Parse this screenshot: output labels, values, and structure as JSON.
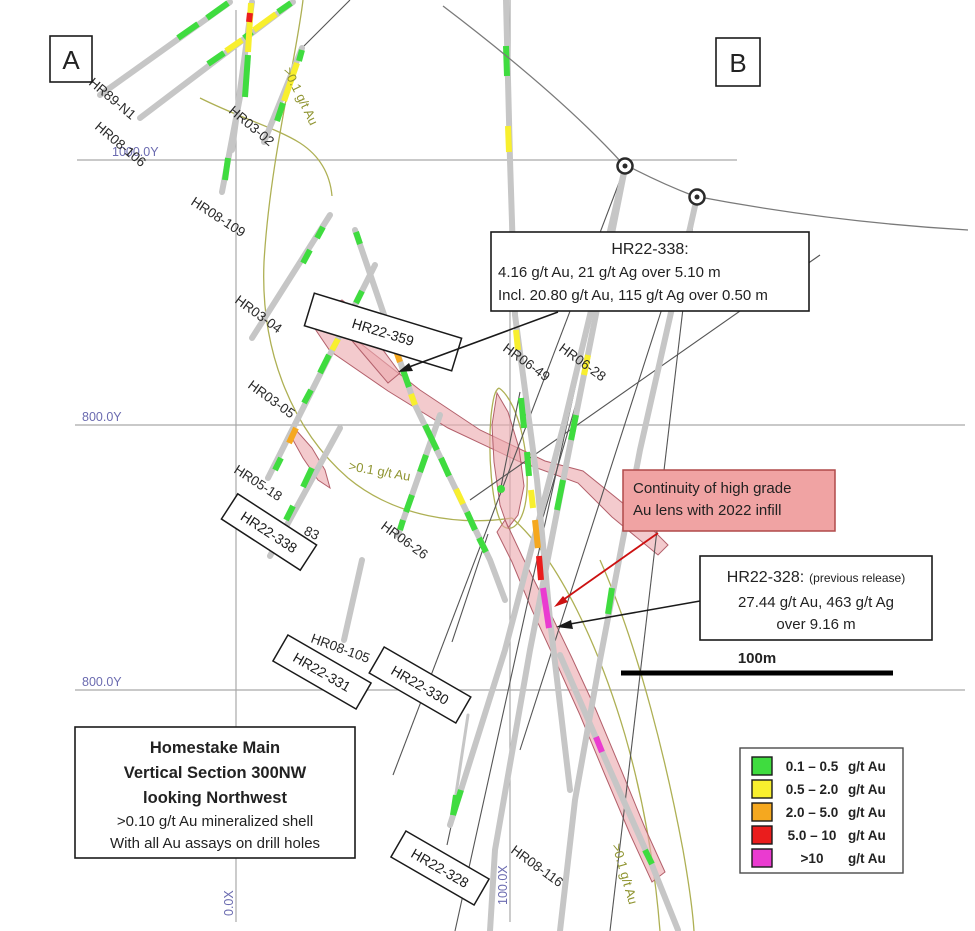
{
  "markers": {
    "a": "A",
    "b": "B"
  },
  "axis_labels": {
    "y1000": "1000.0Y",
    "y800a": "800.0Y",
    "y800b": "800.0Y",
    "x0": "0.0X",
    "x100": "100.0X"
  },
  "drill_labels": [
    "HR89-N1",
    "HR08-106",
    "HR03-02",
    "HR08-109",
    "HR03-04",
    "HR03-05",
    "HR05-18",
    "83",
    "HR06-49",
    "HR06-28",
    "HR06-26",
    "HR08-105",
    "HR08-116"
  ],
  "boxed_labels": [
    "HR22-359",
    "HR22-338",
    "HR22-331",
    "HR22-330",
    "HR22-328"
  ],
  "shell_labels": [
    ">0.1 g/t Au",
    ">0.1 g/t Au",
    ">0.1 g/t Au"
  ],
  "annotations": {
    "hr22_338": {
      "title": "HR22-338:",
      "line1": "4.16 g/t Au, 21 g/t Ag over 5.10 m",
      "line2": "Incl. 20.80 g/t Au, 115 g/t Ag over 0.50 m"
    },
    "continuity": {
      "line1": "Continuity of high grade",
      "line2": "Au lens with 2022 infill"
    },
    "hr22_328": {
      "title": "HR22-328:",
      "title_suffix": "(previous release)",
      "line1": "27.44 g/t Au, 463 g/t Ag",
      "line2": "over 9.16 m"
    }
  },
  "title_box": {
    "line1": "Homestake Main",
    "line2": "Vertical Section 300NW",
    "line3": "looking Northwest",
    "line4": ">0.10 g/t Au mineralized shell",
    "line5": "With all Au assays on drill holes"
  },
  "scale_bar": {
    "label": "100m"
  },
  "legend": {
    "items": [
      {
        "color": "#3fdc3f",
        "range": "0.1 – 0.5",
        "unit": "g/t Au"
      },
      {
        "color": "#f8ef2e",
        "range": "0.5 – 2.0",
        "unit": "g/t Au"
      },
      {
        "color": "#f5a81f",
        "range": "2.0 – 5.0",
        "unit": "g/t Au"
      },
      {
        "color": "#ea1d1d",
        "range": "5.0 – 10",
        "unit": "g/t Au"
      },
      {
        "color": "#ea3bd0",
        "range": ">10",
        "unit": "g/t Au"
      }
    ]
  },
  "colors": {
    "grade_low": "#3fdc3f",
    "grade_mid": "#f8ef2e",
    "grade_high": "#f5a81f",
    "grade_vhigh": "#ea1d1d",
    "grade_bonanza": "#ea3bd0",
    "lens_pink": "#ecaaaf",
    "continuity_fill": "#f0a3a3",
    "red_arrow": "#cc1111"
  }
}
